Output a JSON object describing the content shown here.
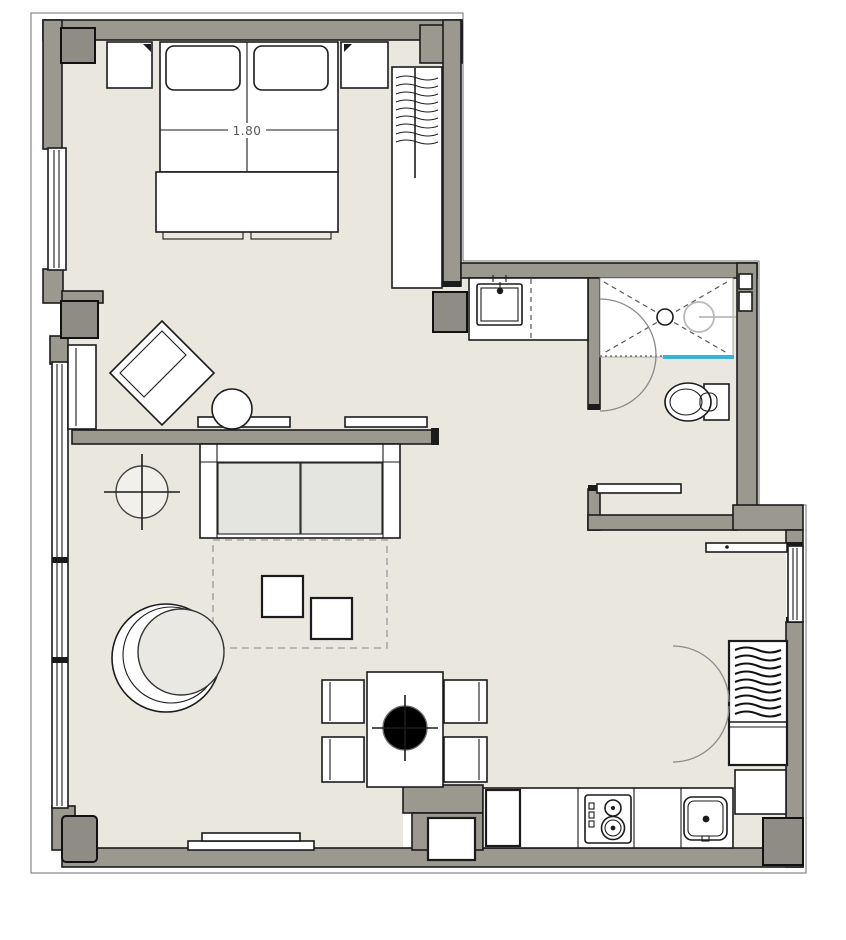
{
  "plan": {
    "bed_size_label": "1.80"
  },
  "colors": {
    "wall": "#9b9890",
    "column": "#8e8c84",
    "floor": "#eae7df",
    "line": "#1b1b1b",
    "glass": "#36b3dc",
    "cushion": "#e4e4e1",
    "seat": "#e9e8e3",
    "paper": "#ffffff"
  },
  "symbols": {
    "bed": "double-bed-icon",
    "pillows": "pillow-icon",
    "nightstand": "nightstand-icon",
    "wardrobe": "hanging-clothes-icon",
    "vanity": "washbasin-icon",
    "shower": "shower-drain-icon",
    "shower_screen": "glass-screen-icon",
    "toilet": "toilet-icon",
    "sofa": "sofa-icon",
    "lounge_chair": "round-chair-icon",
    "accent_chair": "rotated-armchair-icon",
    "side_table": "round-table-icon",
    "coffee_tables": "square-table-icon",
    "dining_table": "dining-table-icon",
    "dining_chair": "chair-icon",
    "plant": "plant-crosshair-icon",
    "stove": "cooktop-icon",
    "kitchen_sink": "sink-icon",
    "tv_console": "sideboard-icon",
    "radiator": "radiator-icon",
    "rug": "rug-outline-icon",
    "entry_closet": "hanging-clothes-icon",
    "door_swing": "door-arc-icon"
  }
}
